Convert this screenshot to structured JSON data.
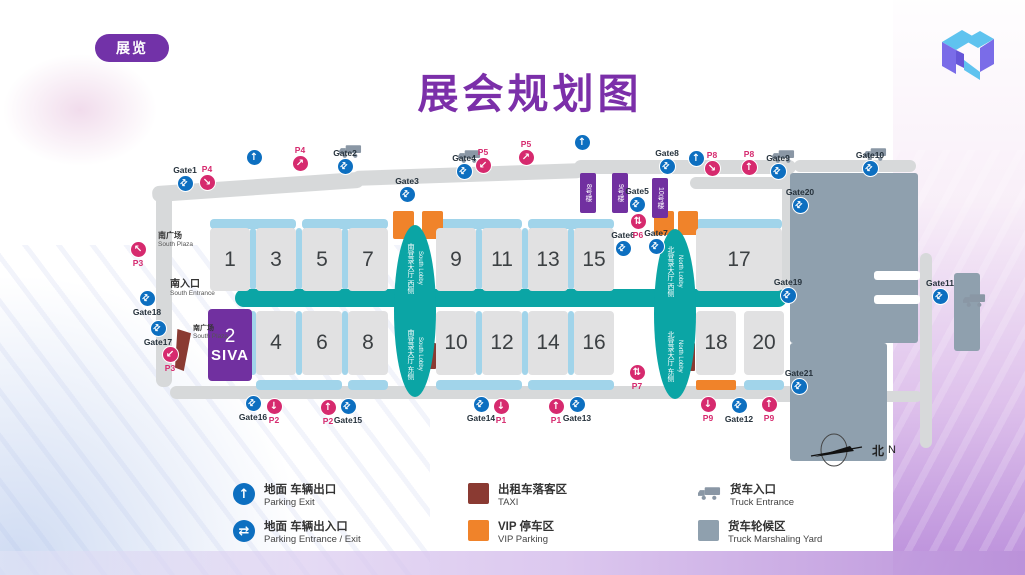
{
  "slide": {
    "badge": "展览",
    "title": "展会规划图"
  },
  "compass": {
    "zh": "北",
    "en": "N"
  },
  "colors": {
    "accent_purple": "#7130a0",
    "teal": "#0ba5a5",
    "light_blue": "#a1d4ea",
    "gate_blue": "#0d6fc0",
    "parking_pink": "#d62a6e",
    "vip_orange": "#f0832a",
    "taxi_red": "#8a3a32",
    "yard_gray": "#8fa0ae",
    "road_gray": "#d7d9da"
  },
  "map": {
    "corridor": {
      "x": 105,
      "y": 156,
      "w": 552,
      "h": 18
    },
    "rects": [
      {
        "k": "road",
        "x": 22,
        "y": 46,
        "w": 212,
        "h": 16,
        "rot": -4
      },
      {
        "k": "road",
        "x": 222,
        "y": 34,
        "w": 232,
        "h": 15,
        "rot": -2
      },
      {
        "k": "road",
        "x": 444,
        "y": 27,
        "w": 222,
        "h": 14,
        "rot": 0
      },
      {
        "k": "road",
        "x": 26,
        "y": 56,
        "w": 16,
        "h": 198,
        "rot": 0
      },
      {
        "k": "road",
        "x": 40,
        "y": 253,
        "w": 625,
        "h": 13,
        "rot": 0
      },
      {
        "k": "road",
        "x": 652,
        "y": 40,
        "w": 12,
        "h": 122,
        "rot": 0
      },
      {
        "k": "road",
        "x": 560,
        "y": 44,
        "w": 104,
        "h": 12,
        "rot": 0
      },
      {
        "k": "road",
        "x": 664,
        "y": 27,
        "w": 122,
        "h": 12,
        "rot": 0
      },
      {
        "k": "road",
        "x": 790,
        "y": 120,
        "w": 12,
        "h": 195,
        "rot": 0
      },
      {
        "k": "road",
        "x": 640,
        "y": 258,
        "w": 152,
        "h": 11,
        "rot": 0
      },
      {
        "k": "yard",
        "x": 660,
        "y": 40,
        "w": 128,
        "h": 170
      },
      {
        "k": "yard",
        "x": 660,
        "y": 210,
        "w": 97,
        "h": 118
      },
      {
        "k": "yard",
        "x": 824,
        "y": 140,
        "w": 26,
        "h": 78
      },
      {
        "k": "notch",
        "x": 744,
        "y": 138,
        "w": 46,
        "h": 9
      },
      {
        "k": "notch",
        "x": 744,
        "y": 162,
        "w": 46,
        "h": 9
      },
      {
        "k": "hbar",
        "x": 80,
        "y": 86,
        "w": 86,
        "h": 10
      },
      {
        "k": "hbar",
        "x": 172,
        "y": 86,
        "w": 86,
        "h": 10
      },
      {
        "k": "hbar",
        "x": 306,
        "y": 86,
        "w": 86,
        "h": 10
      },
      {
        "k": "hbar",
        "x": 398,
        "y": 86,
        "w": 86,
        "h": 10
      },
      {
        "k": "hbar",
        "x": 566,
        "y": 86,
        "w": 86,
        "h": 10
      },
      {
        "k": "hbar",
        "x": 126,
        "y": 247,
        "w": 86,
        "h": 10
      },
      {
        "k": "hbar",
        "x": 218,
        "y": 247,
        "w": 40,
        "h": 10
      },
      {
        "k": "hbar",
        "x": 306,
        "y": 247,
        "w": 86,
        "h": 10
      },
      {
        "k": "hbar",
        "x": 398,
        "y": 247,
        "w": 86,
        "h": 10
      },
      {
        "k": "hbar",
        "x": 614,
        "y": 247,
        "w": 40,
        "h": 10
      },
      {
        "k": "vbar",
        "x": 120,
        "y": 95,
        "w": 6,
        "h": 62
      },
      {
        "k": "vbar",
        "x": 166,
        "y": 95,
        "w": 6,
        "h": 62
      },
      {
        "k": "vbar",
        "x": 212,
        "y": 95,
        "w": 6,
        "h": 62
      },
      {
        "k": "vbar",
        "x": 346,
        "y": 95,
        "w": 6,
        "h": 62
      },
      {
        "k": "vbar",
        "x": 392,
        "y": 95,
        "w": 6,
        "h": 62
      },
      {
        "k": "vbar",
        "x": 438,
        "y": 95,
        "w": 6,
        "h": 62
      },
      {
        "k": "vbar",
        "x": 120,
        "y": 178,
        "w": 6,
        "h": 64
      },
      {
        "k": "vbar",
        "x": 166,
        "y": 178,
        "w": 6,
        "h": 64
      },
      {
        "k": "vbar",
        "x": 212,
        "y": 178,
        "w": 6,
        "h": 64
      },
      {
        "k": "vbar",
        "x": 346,
        "y": 178,
        "w": 6,
        "h": 64
      },
      {
        "k": "vbar",
        "x": 392,
        "y": 178,
        "w": 6,
        "h": 64
      },
      {
        "k": "vbar",
        "x": 438,
        "y": 178,
        "w": 6,
        "h": 64
      },
      {
        "k": "vip",
        "x": 263,
        "y": 78,
        "w": 21,
        "h": 28
      },
      {
        "k": "vip",
        "x": 292,
        "y": 78,
        "w": 21,
        "h": 28
      },
      {
        "k": "vip",
        "x": 524,
        "y": 78,
        "w": 20,
        "h": 24
      },
      {
        "k": "vip",
        "x": 548,
        "y": 78,
        "w": 20,
        "h": 24
      },
      {
        "k": "vip",
        "x": 566,
        "y": 247,
        "w": 40,
        "h": 10
      },
      {
        "k": "taxi",
        "x": 45,
        "y": 196,
        "w": 16,
        "h": 42,
        "wedge": true
      },
      {
        "k": "taxi",
        "x": 297,
        "y": 210,
        "w": 9,
        "h": 26
      },
      {
        "k": "taxi",
        "x": 556,
        "y": 210,
        "w": 9,
        "h": 28
      }
    ],
    "halls": [
      {
        "n": "1",
        "x": 80,
        "y": 95,
        "w": 40,
        "h": 63
      },
      {
        "n": "3",
        "x": 126,
        "y": 95,
        "w": 40,
        "h": 63
      },
      {
        "n": "5",
        "x": 172,
        "y": 95,
        "w": 40,
        "h": 63
      },
      {
        "n": "7",
        "x": 218,
        "y": 95,
        "w": 40,
        "h": 63
      },
      {
        "n": "9",
        "x": 306,
        "y": 95,
        "w": 40,
        "h": 63
      },
      {
        "n": "11",
        "x": 352,
        "y": 95,
        "w": 40,
        "h": 63
      },
      {
        "n": "13",
        "x": 398,
        "y": 95,
        "w": 40,
        "h": 63
      },
      {
        "n": "15",
        "x": 444,
        "y": 95,
        "w": 40,
        "h": 63
      },
      {
        "n": "17",
        "x": 566,
        "y": 95,
        "w": 86,
        "h": 63
      },
      {
        "n": "2",
        "sub": "SIVA",
        "purple": true,
        "x": 78,
        "y": 176,
        "w": 44,
        "h": 72
      },
      {
        "n": "4",
        "x": 126,
        "y": 178,
        "w": 40,
        "h": 64
      },
      {
        "n": "6",
        "x": 172,
        "y": 178,
        "w": 40,
        "h": 64
      },
      {
        "n": "8",
        "x": 218,
        "y": 178,
        "w": 40,
        "h": 64
      },
      {
        "n": "10",
        "x": 306,
        "y": 178,
        "w": 40,
        "h": 64
      },
      {
        "n": "12",
        "x": 352,
        "y": 178,
        "w": 40,
        "h": 64
      },
      {
        "n": "14",
        "x": 398,
        "y": 178,
        "w": 40,
        "h": 64
      },
      {
        "n": "16",
        "x": 444,
        "y": 178,
        "w": 40,
        "h": 64
      },
      {
        "n": "18",
        "x": 566,
        "y": 178,
        "w": 40,
        "h": 64
      },
      {
        "n": "20",
        "x": 614,
        "y": 178,
        "w": 40,
        "h": 64
      }
    ],
    "lobbies": [
      {
        "name": "south-lobby",
        "x": 264,
        "y": 92,
        "w": 42,
        "h": 172,
        "zh_top": "南登录大厅 西侧",
        "en_top": "South Lobby",
        "zh_bottom": "南登录大厅 东侧",
        "en_bottom": "South Lobby"
      },
      {
        "name": "north-lobby",
        "x": 524,
        "y": 96,
        "w": 42,
        "h": 170,
        "zh_top": "北登录大厅 西侧",
        "en_top": "North Lobby",
        "zh_bottom": "北登录大厅 东侧",
        "en_bottom": "North Lobby"
      }
    ],
    "buildings": [
      {
        "label": "8号楼",
        "x": 450,
        "y": 40,
        "w": 16,
        "h": 40
      },
      {
        "label": "9号楼",
        "x": 482,
        "y": 40,
        "w": 16,
        "h": 40
      },
      {
        "label": "10号楼",
        "x": 522,
        "y": 45,
        "w": 16,
        "h": 40
      }
    ],
    "texts": [
      {
        "name": "south-entrance-label",
        "zh": "南入口",
        "en": "South Entrance",
        "x": 40,
        "y": 146,
        "zhsize": 10
      },
      {
        "name": "south-plaza-label",
        "zh": "南广场",
        "en": "South Plaza",
        "x": 28,
        "y": 99,
        "zhsize": 8
      },
      {
        "name": "south-plaza-label-2",
        "zh": "南广场",
        "en": "South Plaza",
        "x": 63,
        "y": 192,
        "zhsize": 7
      }
    ],
    "gates": [
      {
        "label": "Gate1",
        "x": 55,
        "y": 53,
        "lp": "top"
      },
      {
        "label": "Gate2",
        "x": 215,
        "y": 36,
        "lp": "top"
      },
      {
        "label": "Gate3",
        "x": 277,
        "y": 64,
        "lp": "top"
      },
      {
        "label": "Gate4",
        "x": 334,
        "y": 41,
        "lp": "top"
      },
      {
        "label": "Gate5",
        "x": 507,
        "y": 74,
        "lp": "top"
      },
      {
        "label": "Gate6",
        "x": 493,
        "y": 118,
        "lp": "top"
      },
      {
        "label": "Gate7",
        "x": 526,
        "y": 116,
        "lp": "top"
      },
      {
        "label": "Gate8",
        "x": 537,
        "y": 36,
        "lp": "top"
      },
      {
        "label": "Gate9",
        "x": 648,
        "y": 41,
        "lp": "top"
      },
      {
        "label": "Gate10",
        "x": 740,
        "y": 38,
        "lp": "top"
      },
      {
        "label": "Gate11",
        "x": 810,
        "y": 166,
        "lp": "top"
      },
      {
        "label": "Gate12",
        "x": 609,
        "y": 273,
        "lp": "bottom"
      },
      {
        "label": "Gate13",
        "x": 447,
        "y": 272,
        "lp": "bottom"
      },
      {
        "label": "Gate14",
        "x": 351,
        "y": 272,
        "lp": "bottom"
      },
      {
        "label": "Gate15",
        "x": 218,
        "y": 274,
        "lp": "bottom"
      },
      {
        "label": "Gate16",
        "x": 123,
        "y": 271,
        "lp": "bottom"
      },
      {
        "label": "Gate17",
        "x": 28,
        "y": 196,
        "lp": "bottom"
      },
      {
        "label": "Gate18",
        "x": 17,
        "y": 166,
        "lp": "bottom"
      },
      {
        "label": "Gate19",
        "x": 658,
        "y": 165,
        "lp": "top"
      },
      {
        "label": "Gate20",
        "x": 670,
        "y": 75,
        "lp": "top"
      },
      {
        "label": "Gate21",
        "x": 669,
        "y": 256,
        "lp": "top"
      }
    ],
    "parking_markers": [
      {
        "label": "P4",
        "glyph": "↘",
        "x": 77,
        "y": 52,
        "lp": "top"
      },
      {
        "label": "P4",
        "glyph": "↗",
        "x": 170,
        "y": 33,
        "lp": "top"
      },
      {
        "label": "P5",
        "glyph": "↙",
        "x": 353,
        "y": 35,
        "lp": "top"
      },
      {
        "label": "P5",
        "glyph": "↗",
        "x": 396,
        "y": 27,
        "lp": "top"
      },
      {
        "label": "P8",
        "glyph": "↘",
        "x": 582,
        "y": 38,
        "lp": "top"
      },
      {
        "label": "P8",
        "glyph": "↑",
        "x": 619,
        "y": 37,
        "lp": "top"
      },
      {
        "label": "P6",
        "glyph": "⇅",
        "x": 508,
        "y": 89,
        "lp": "bottom"
      },
      {
        "label": "P7",
        "glyph": "⇅",
        "x": 507,
        "y": 240,
        "lp": "bottom"
      },
      {
        "label": "P3",
        "glyph": "↖",
        "x": 8,
        "y": 117,
        "lp": "bottom"
      },
      {
        "label": "P3",
        "glyph": "↙",
        "x": 40,
        "y": 222,
        "lp": "bottom"
      },
      {
        "label": "P2",
        "glyph": "↓",
        "x": 144,
        "y": 274,
        "lp": "bottom"
      },
      {
        "label": "P2",
        "glyph": "↑",
        "x": 198,
        "y": 275,
        "lp": "bottom"
      },
      {
        "label": "P1",
        "glyph": "↓",
        "x": 371,
        "y": 274,
        "lp": "bottom"
      },
      {
        "label": "P1",
        "glyph": "↑",
        "x": 426,
        "y": 274,
        "lp": "bottom"
      },
      {
        "label": "P9",
        "glyph": "↓",
        "x": 578,
        "y": 272,
        "lp": "bottom"
      },
      {
        "label": "P9",
        "glyph": "↑",
        "x": 639,
        "y": 272,
        "lp": "bottom"
      }
    ],
    "exit_arrows": [
      {
        "x": 124,
        "y": 37
      },
      {
        "x": 452,
        "y": 22
      },
      {
        "x": 566,
        "y": 38
      }
    ],
    "trucks": [
      {
        "x": 209,
        "y": 11
      },
      {
        "x": 328,
        "y": 16
      },
      {
        "x": 642,
        "y": 16
      },
      {
        "x": 734,
        "y": 14
      },
      {
        "x": 833,
        "y": 160
      }
    ]
  },
  "legend": {
    "items": [
      {
        "kind": "exit",
        "zh": "地面 车辆出口",
        "en": "Parking Exit",
        "x": 233,
        "y": 483
      },
      {
        "kind": "inout",
        "zh": "地面 车辆出入口",
        "en": "Parking Entrance / Exit",
        "x": 233,
        "y": 520
      },
      {
        "kind": "swatch",
        "color": "#8a3a32",
        "zh": "出租车落客区",
        "en": "TAXI",
        "x": 468,
        "y": 483
      },
      {
        "kind": "swatch",
        "color": "#f0832a",
        "zh": "VIP 停车区",
        "en": "VIP Parking",
        "x": 468,
        "y": 520
      },
      {
        "kind": "truck",
        "zh": "货车入口",
        "en": "Truck Entrance",
        "x": 698,
        "y": 483
      },
      {
        "kind": "swatch",
        "color": "#8fa0ae",
        "zh": "货车轮候区",
        "en": "Truck Marshaling Yard",
        "x": 698,
        "y": 520
      }
    ]
  }
}
